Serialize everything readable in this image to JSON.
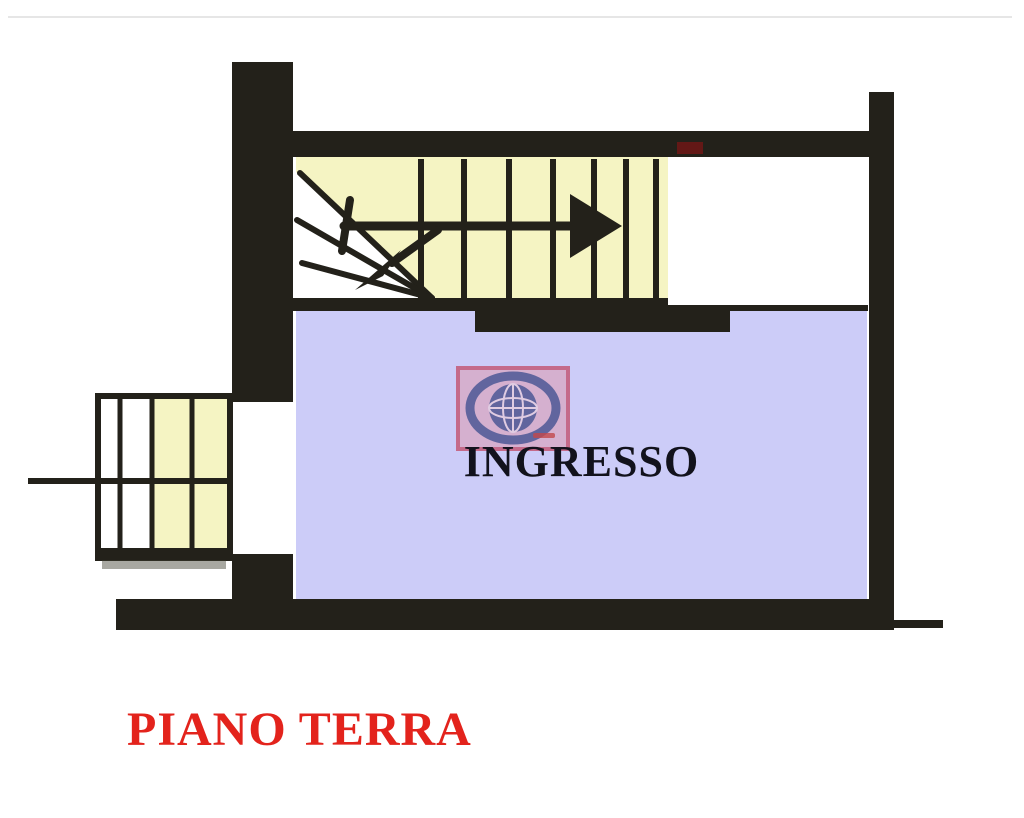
{
  "page": {
    "type": "floor-plan-image"
  },
  "plan": {
    "room_label": "INGRESSO",
    "floor_label": "PIANO TERRA"
  },
  "colors": {
    "wall": "#23211a",
    "stair": "#f5f4c3",
    "room": "#ccccf8",
    "red-label": "#e3231c",
    "label-text": "#12121c",
    "logo-pink": "#d7aecb",
    "logo-border": "#c4607f",
    "logo-navy": "#565a95",
    "logo-grid": "#e3cce0",
    "logo-red": "#c23a3a"
  },
  "watermark": {
    "icon": "globe-logo"
  }
}
